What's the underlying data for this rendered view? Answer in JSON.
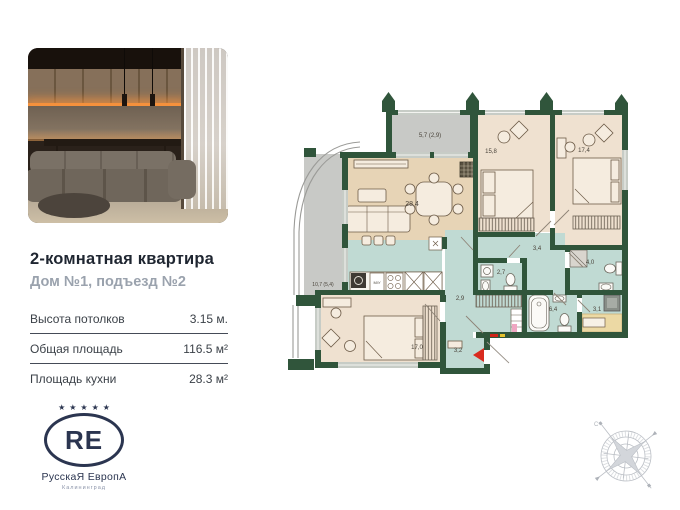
{
  "listing": {
    "title": "2-комнатная квартира",
    "subtitle": "Дом №1, подъезд №2",
    "specs": [
      {
        "label": "Высота потолков",
        "value": "3.15 м."
      },
      {
        "label": "Общая площадь",
        "value": "116.5 м²"
      },
      {
        "label": "Площадь кухни",
        "value": "28.3 м²"
      }
    ]
  },
  "logo": {
    "stars": "★★★★★",
    "monogram": "RE",
    "brand": "РусскаЯ ЕвропА",
    "city": "Калининград"
  },
  "plan": {
    "rooms": [
      {
        "id": "living",
        "area": "28,4"
      },
      {
        "id": "balcony-top",
        "area": "5,7 (2,9)"
      },
      {
        "id": "bedroom-top",
        "area": "15,8"
      },
      {
        "id": "bedroom-right",
        "area": "17,4"
      },
      {
        "id": "balcony-left",
        "area": "10,7 (5,4)"
      },
      {
        "id": "wc",
        "area": "2,7"
      },
      {
        "id": "hall",
        "area": "3,4"
      },
      {
        "id": "bathroom-right",
        "area": "4,0"
      },
      {
        "id": "corridor",
        "area": "2,9"
      },
      {
        "id": "bathroom-main",
        "area": "6,4"
      },
      {
        "id": "storage",
        "area": "3,1"
      },
      {
        "id": "bedroom-bottom",
        "area": "17,0"
      },
      {
        "id": "entry",
        "area": "3,2"
      }
    ],
    "kitchen_unit_label": "М/У",
    "colors": {
      "wall": "#30553b",
      "floor_living": "#e7d4b6",
      "floor_bedroom": "#efe1d0",
      "floor_wet": "#c0dad3",
      "floor_balcony": "#c8c9c6",
      "entrance_arrow": "#d92b1f"
    }
  },
  "compass": {
    "north_label": "С"
  }
}
